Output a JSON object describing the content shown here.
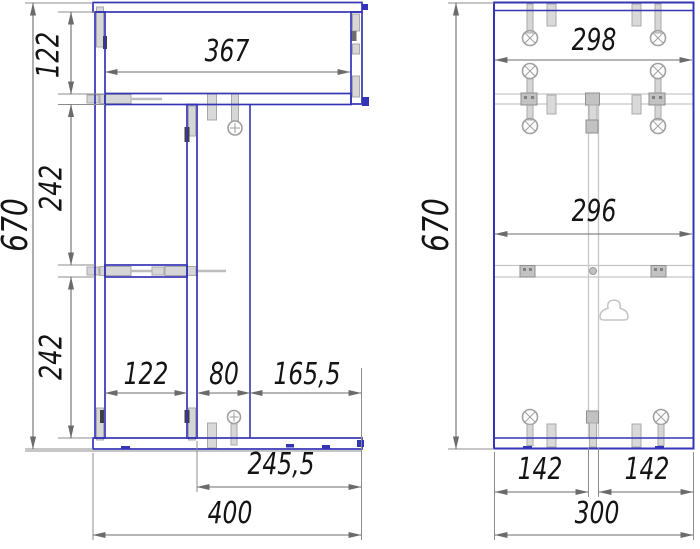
{
  "document": {
    "type": "furniture-assembly-drawing",
    "background": "#ffffff"
  },
  "colors": {
    "panel_outline": "#3434b6",
    "hardware_gray": "#c6c6c6",
    "hidden_line_gray": "#c7c7c7",
    "dimension_line": "#6b6b6b",
    "label_text": "#141414"
  },
  "front_view": {
    "labels": {
      "total_height": "670",
      "top_section_height": "122",
      "middle_section_height": "242",
      "bottom_section_height": "242",
      "top_inner_width": "367",
      "left_bay_width": "122",
      "center_gap_width": "80",
      "right_bay_width": "165,5",
      "lower_right_width": "245,5",
      "total_width": "400"
    }
  },
  "side_view": {
    "labels": {
      "total_height": "670",
      "top_inner_width": "298",
      "middle_inner_width": "296",
      "left_offset": "142",
      "right_offset": "142",
      "total_width": "300"
    }
  }
}
